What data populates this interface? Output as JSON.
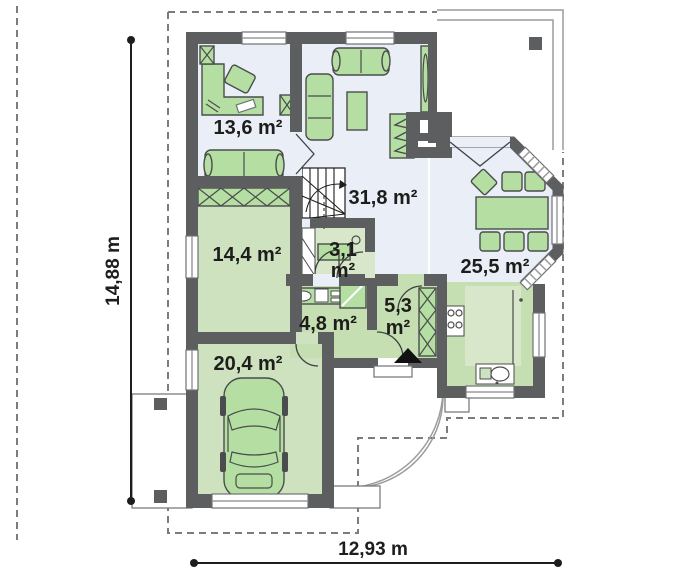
{
  "plan": {
    "title": "single-storey house floor plan",
    "rooms": [
      {
        "id": "study",
        "label_lines": [
          "13,6 m²"
        ]
      },
      {
        "id": "living-room",
        "label_lines": [
          "31,8 m²"
        ]
      },
      {
        "id": "kitchen-dining",
        "label_lines": [
          "25,5 m²"
        ]
      },
      {
        "id": "bedroom",
        "label_lines": [
          "14,4 m²"
        ]
      },
      {
        "id": "pantry",
        "label_lines": [
          "3,1",
          "m²"
        ]
      },
      {
        "id": "bathroom",
        "label_lines": [
          "4,8 m²"
        ]
      },
      {
        "id": "hall",
        "label_lines": [
          "5,3",
          "m²"
        ]
      },
      {
        "id": "garage",
        "label_lines": [
          "20,4 m²"
        ]
      }
    ],
    "dimensions": {
      "width_label": "12,93 m",
      "height_label": "14,88 m"
    },
    "colors": {
      "wall": "#5c5e5f",
      "floor_blue": "#eaeef7",
      "floor_green": "#cfe2bf",
      "furniture_green": "#b5dfa2",
      "dimension_black": "#1d1d1b"
    }
  }
}
